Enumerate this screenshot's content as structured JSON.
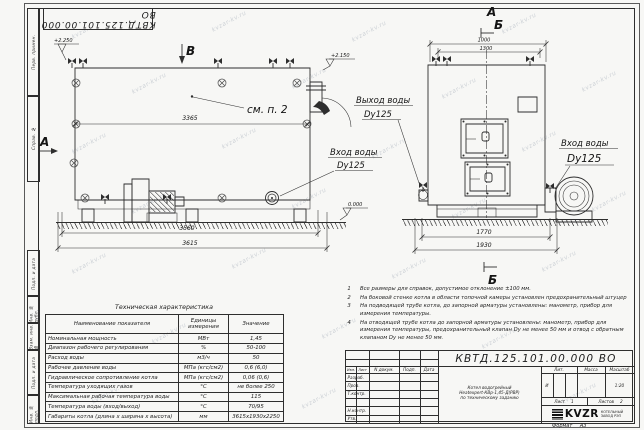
{
  "page": {
    "watermark": "kvzar-kv.ru",
    "stamp_top": "КВТД.125.101.00.000 ВО",
    "format_label": "Формат",
    "format_value": "А3"
  },
  "frame_strip": {
    "labels": [
      "Перв. примен.",
      "Справ. №",
      "Подп. и дата",
      "Инв. № дубл.",
      "Взам. инв. №",
      "Подп. и дата",
      "Инв. № подл."
    ]
  },
  "drawing": {
    "view_b_label": "В",
    "section_a_left": "А",
    "see_note": "см. п. 2",
    "elev_top_left": "+2.250",
    "elev_top_right": "+2.150",
    "elev_zero": "0.000",
    "dim_3365": "3365",
    "dim_3560": "3560",
    "dim_3615": "3615",
    "dim_1000": "1000",
    "dim_1300": "1300",
    "dim_1770": "1770",
    "dim_1930": "1930",
    "label_a_top": "А",
    "label_b_top": "Б",
    "label_b_bottom": "Б",
    "water_in_left": "Вход воды",
    "water_in_left_dn": "Dy125",
    "water_out": "Выход воды",
    "water_out_dn": "Dy125",
    "water_in_right": "Вход воды",
    "water_in_right_dn": "Dy125"
  },
  "notes": [
    {
      "num": "1",
      "text": "Все размеры для справок, допустимое отклонение ±100 мм."
    },
    {
      "num": "2",
      "text": "На боковой стенке котла в области топочной камеры установлен предохранительный штуцер"
    },
    {
      "num": "3",
      "text": "На подводящей трубе котла, до запорной арматуры установлены: манометр, прибор для измерения температуры."
    },
    {
      "num": "4",
      "text": "На отводящей трубе котла до запорной арматуры установлены: манометр, прибор для измерения температуры, предохранительный клапан Dу не менее 50 мм и отвод с обратным клапаном Dу не менее 50 мм."
    }
  ],
  "tech_table": {
    "title": "Техническая характеристика",
    "headers": {
      "name": "Наименование показателя",
      "units": "Единицы измерения",
      "value": "Значение"
    },
    "rows": [
      {
        "name": "Номинальная мощность",
        "units": "МВт",
        "value": "1,45"
      },
      {
        "name": "Диапазон рабочего регулирования",
        "units": "%",
        "value": "50-100"
      },
      {
        "name": "Расход воды",
        "units": "м3/ч",
        "value": "50"
      },
      {
        "name": "Рабочее давление воды",
        "units": "МПа (кгс/см2)",
        "value": "0,6 (6,0)"
      },
      {
        "name": "Гидравлическое сопротивление котла",
        "units": "МПа (кгс/см2)",
        "value": "0,06 (0,6)"
      },
      {
        "name": "Температура уходящих газов",
        "units": "°С",
        "value": "не более 250"
      },
      {
        "name": "Максимальная рабочая температура воды",
        "units": "°С",
        "value": "115"
      },
      {
        "name": "Температура воды (вход/выход)",
        "units": "°С",
        "value": "70/95"
      },
      {
        "name": "Габариты котла (длина х ширина х высота)",
        "units": "мм",
        "value": "3615х1930х2250"
      }
    ]
  },
  "title_block": {
    "doc_number": "КВТД.125.101.00.000  ВО",
    "header_cols": {
      "izm": "Изм.",
      "list": "Лист",
      "doc": "N докум.",
      "sign": "Подп.",
      "date": "Дата"
    },
    "roles": {
      "r1": "Разраб.",
      "r2": "Пров.",
      "r3": "Т.контр.",
      "r4": "Н.контр.",
      "r5": "Утв."
    },
    "description": {
      "line1": "Котел водогрейный",
      "line2": "Heatexpert-КВр-1,45-Д(РВР)",
      "line3": "по техническому заданию"
    },
    "lit": {
      "header": "Лит.",
      "value": "И"
    },
    "mass": {
      "header": "Масса"
    },
    "scale": {
      "header": "Масштаб",
      "value": "1:20"
    },
    "sheet": {
      "label": "Лист",
      "value": "1",
      "label2": "Листов",
      "value2": "2"
    },
    "logo": {
      "text": "KVZR",
      "caption1": "КОТЕЛЬНЫЙ",
      "caption2": "ЗАВОД РЭП"
    }
  }
}
